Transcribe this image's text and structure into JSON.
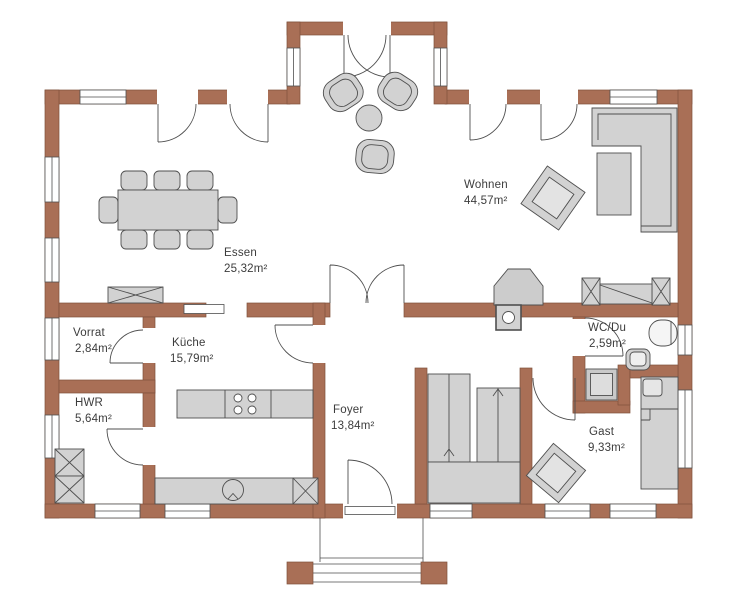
{
  "plan_title": "Erdgeschoss Grundriss",
  "rooms": [
    {
      "id": "wohnen",
      "name": "Wohnen",
      "area": "44,57m²"
    },
    {
      "id": "essen",
      "name": "Essen",
      "area": "25,32m²"
    },
    {
      "id": "vorrat",
      "name": "Vorrat",
      "area": "2,84m²"
    },
    {
      "id": "kueche",
      "name": "Küche",
      "area": "15,79m²"
    },
    {
      "id": "hwr",
      "name": "HWR",
      "area": "5,64m²"
    },
    {
      "id": "foyer",
      "name": "Foyer",
      "area": "13,84m²"
    },
    {
      "id": "wc",
      "name": "WC/Du",
      "area": "2,59m²"
    },
    {
      "id": "gast",
      "name": "Gast",
      "area": "9,33m²"
    }
  ],
  "colors": {
    "wall": "#a96f56",
    "wall_outline": "#80513d",
    "furniture": "#d2d2d2",
    "furniture_light": "#e3e3e3",
    "line": "#4f4f4f",
    "background": "#ffffff"
  }
}
